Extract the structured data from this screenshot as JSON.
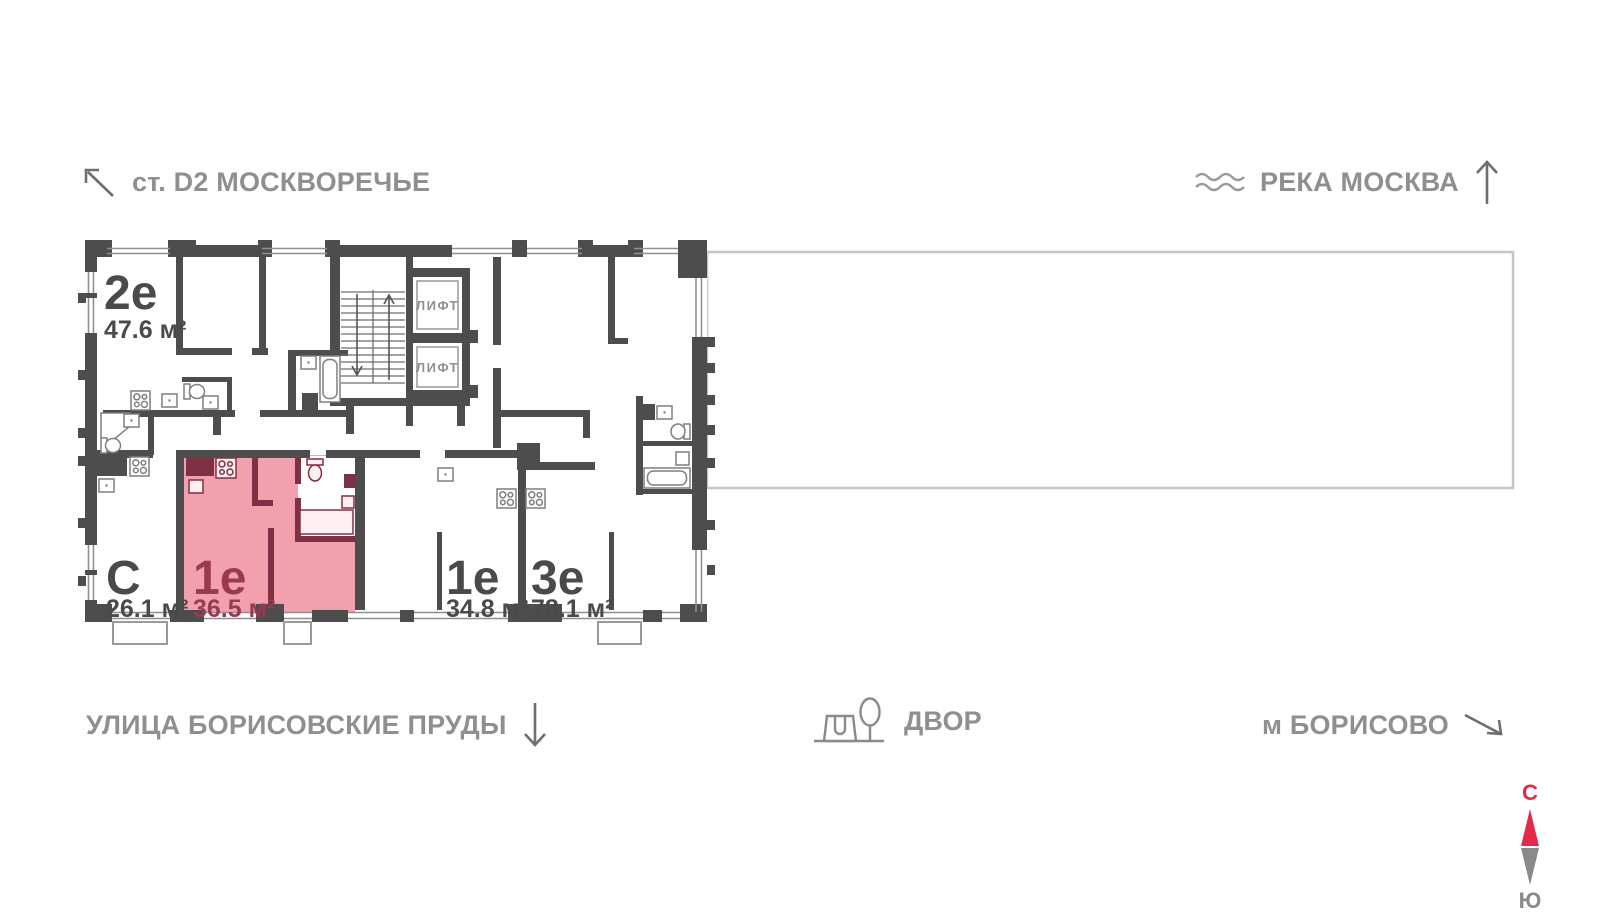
{
  "landmarks": {
    "station": "ст. D2 МОСКВОРЕЧЬЕ",
    "river": "РЕКА МОСКВА",
    "street": "УЛИЦА БОРИСОВСКИЕ ПРУДЫ",
    "yard": "ДВОР",
    "metro": "м БОРИСОВО"
  },
  "compass": {
    "north": "С",
    "south": "Ю"
  },
  "floorplan": {
    "apartments": [
      {
        "type": "2е",
        "area": "47.6 м²",
        "highlighted": false
      },
      {
        "type": "С",
        "area": "26.1 м²",
        "highlighted": false
      },
      {
        "type": "1е",
        "area": "36.5 м²",
        "highlighted": true
      },
      {
        "type": "1е",
        "area": "34.8 м²",
        "highlighted": false
      },
      {
        "type": "3е",
        "area": "78.1 м²",
        "highlighted": false
      }
    ],
    "elevators": [
      "ЛИФТ",
      "ЛИФТ"
    ],
    "colors": {
      "walls": "#4d4d4d",
      "highlight_fill": "#f2a0ae",
      "highlight_walls": "#7e3044",
      "highlight_text": "#973a52",
      "annotation_text": "#8f8f8f",
      "compass_north": "#e5294a"
    }
  }
}
